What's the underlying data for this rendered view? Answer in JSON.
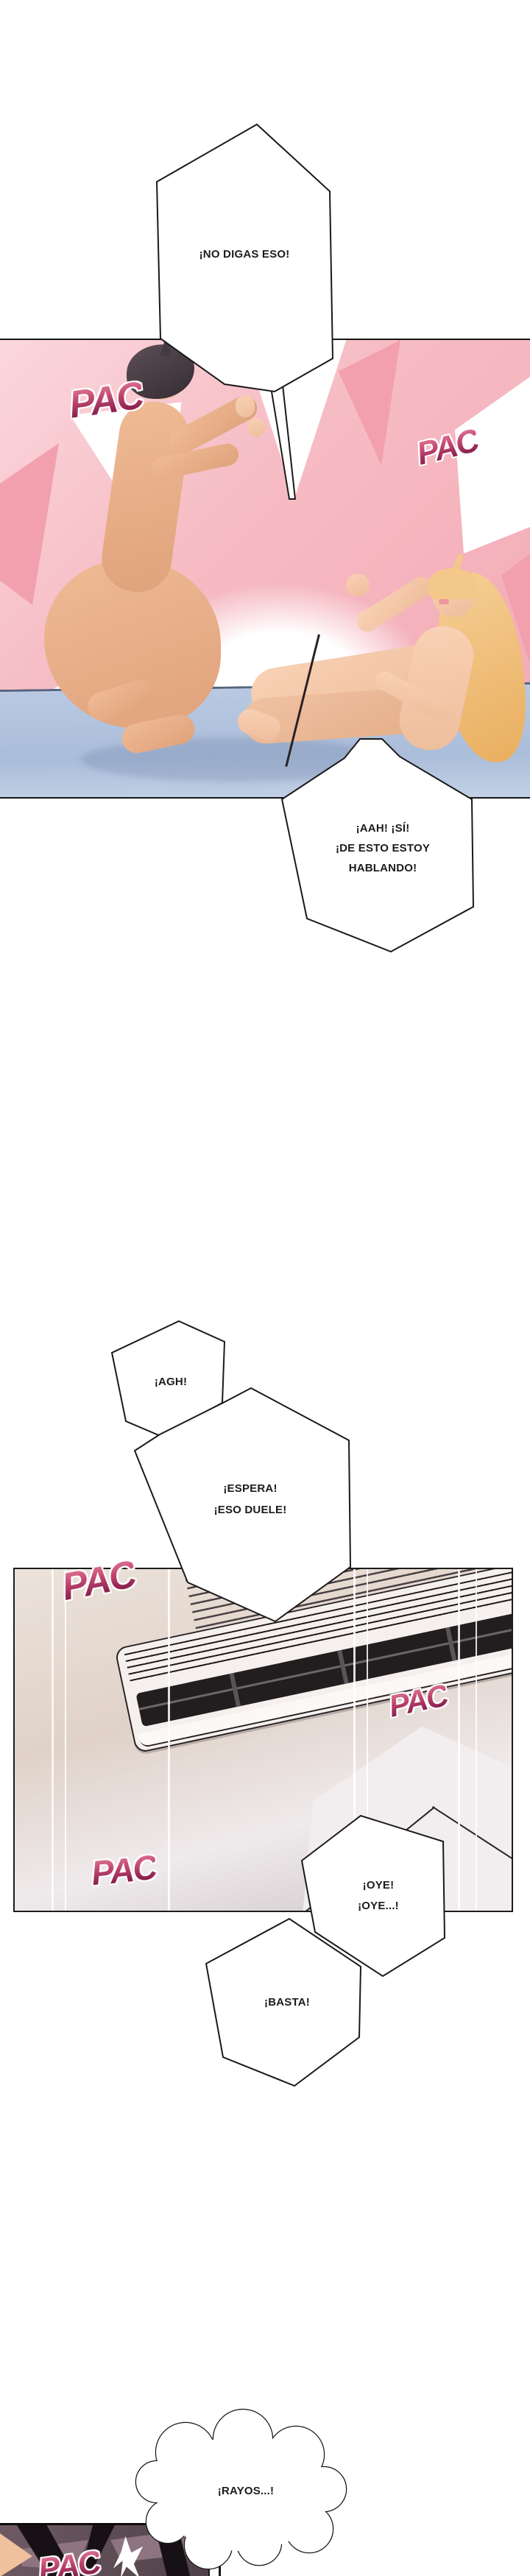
{
  "bubbles": {
    "no_digas": "¡NO DIGAS ESO!",
    "aah_lines": [
      "¡AAH! ¡SÍ!",
      "¡DE ESTO ESTOY",
      "HABLANDO!"
    ],
    "agh": "¡AGH!",
    "espera_lines": [
      "¡ESPERA!",
      "¡ESO DUELE!"
    ],
    "oye_lines": [
      "¡OYE!",
      "¡OYE...!"
    ],
    "basta": "¡BASTA!",
    "rayos": "¡RAYOS...!"
  },
  "sfx": {
    "pac": "PAC"
  },
  "colors": {
    "page_bg": "#ffffff",
    "panel1_pink": "#f5b9c1",
    "panel1_pink_light": "#fbd7dc",
    "mat_blue": "#b3c6e1",
    "skin_light": "#f8d0b4",
    "skin_tan": "#e7ae87",
    "hair_male": "#453a41",
    "hair_female": "#f3c98e",
    "bubble_fill": "#ffffff",
    "bubble_border": "#1a1a1a",
    "text": "#1c1c1c",
    "sfx_gradient_top": "#e27b97",
    "sfx_gradient_bottom": "#701440",
    "sfx_outline": "#ffffff",
    "panel2_beige": "#e7dcd3",
    "ac_body": "#f5f0ed",
    "ac_vent": "#221e20",
    "panel3_base": "#5c4b53",
    "panel3_spike": "#171115",
    "panel3_flash": "#ffffff"
  }
}
